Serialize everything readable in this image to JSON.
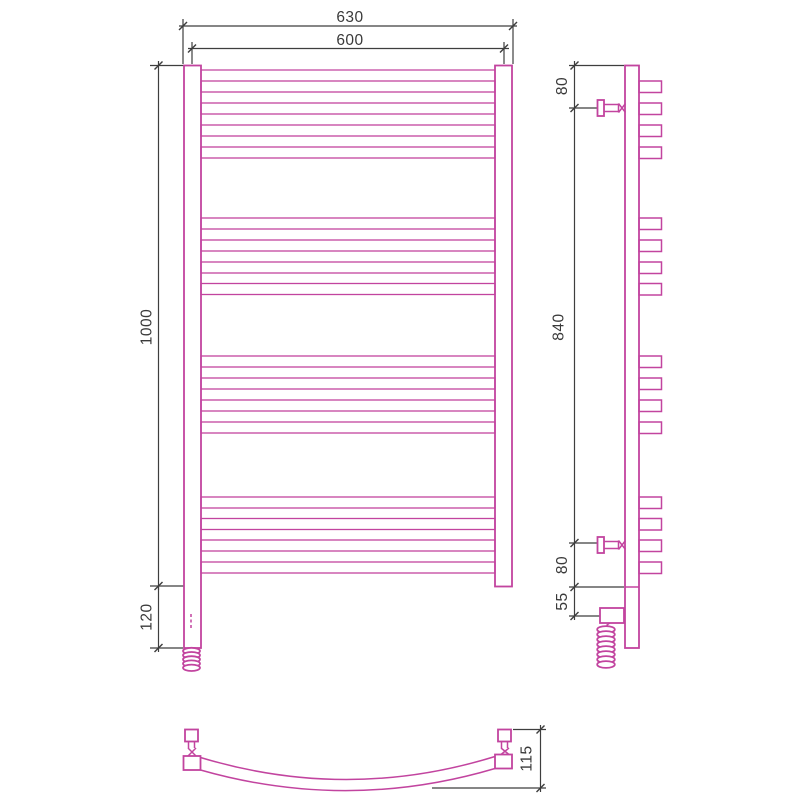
{
  "colors": {
    "drawing_outline": "#c2449f",
    "dimension_lines": "#3e3e3e",
    "background": "#ffffff"
  },
  "dimensions": {
    "overall_width": "630",
    "center_width": "600",
    "height": "1000",
    "lower_extension": "120",
    "side_top_offset": "80",
    "side_bracket_span": "840",
    "side_bottom_offset": "80",
    "side_heater_offset": "55",
    "depth": "115"
  },
  "structure": {
    "bar_row_tops": [
      81,
      103,
      125,
      147,
      218,
      240,
      262,
      283.5,
      356,
      378,
      400,
      422,
      497,
      518.5,
      540,
      562
    ],
    "bar_height": 11,
    "front_bar_x": 201,
    "front_bar_width": 294,
    "side_tab_x": 639,
    "side_tab_width": 22.5,
    "coil_front": {
      "cx": 191.5,
      "cy_start": 651,
      "loops": 5,
      "step": 4.2,
      "rx": 8.5,
      "ry": 3.2
    },
    "coil_side": {
      "cx": 606,
      "cy_start": 629.5,
      "loops": 8,
      "step": 5,
      "rx": 8.8,
      "ry": 3.4
    }
  }
}
